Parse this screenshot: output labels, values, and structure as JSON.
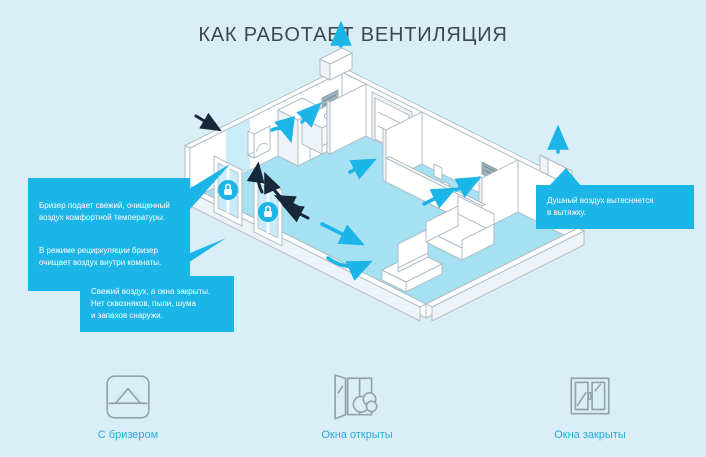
{
  "title": "КАК РАБОТАЕТ ВЕНТИЛЯЦИЯ",
  "callouts": {
    "breezer": {
      "p1": "Бризер подает свежий, очищенный\nвоздух комфортной температуры.",
      "p2": "В режиме рециркуляции бризер\nочищает воздух внутри комнаты."
    },
    "fresh_air": "Свежий воздух, а окна закрыты.\nНет сквозняков, пыли, шума\nи запахов снаружи.",
    "exhaust": "Душный воздух вытесняется\nв вытяжку."
  },
  "legend": [
    {
      "label": "С бризером",
      "icon": "breezer-device-icon"
    },
    {
      "label": "Окна открыты",
      "icon": "window-open-cloud-icon"
    },
    {
      "label": "Окна закрыты",
      "icon": "window-closed-icon"
    }
  ],
  "colors": {
    "background": "#d9eef6",
    "accent_cyan": "#1cb5e8",
    "floor": "#a6e1f3",
    "dark_arrow": "#16283a",
    "title_text": "#3e484f",
    "legend_label": "#2aa9da",
    "outline_gray": "#aebcc4"
  }
}
